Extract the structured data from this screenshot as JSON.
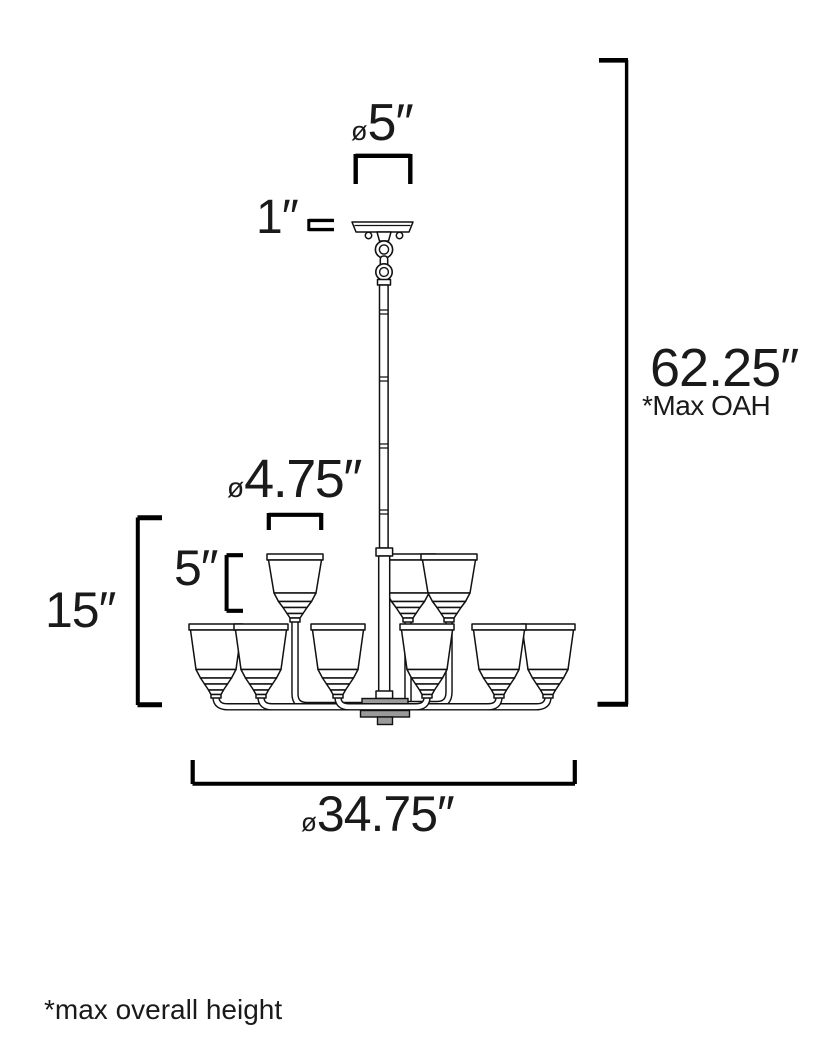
{
  "drawing": {
    "subject": "Two-tier chandelier dimensional line drawing",
    "upper_tier_shades": 3,
    "lower_tier_shades": 6,
    "colors": {
      "line": "#111111",
      "bracket": "#000000",
      "hub_fill": "#9a9a9a",
      "text": "#1a1a1a",
      "background": "#ffffff"
    }
  },
  "annotations": {
    "canopy_diameter": {
      "prefix": "ø",
      "value": "5″"
    },
    "canopy_height": {
      "value": "1″"
    },
    "max_overall_height": {
      "value": "62.25″",
      "note": "*Max OAH"
    },
    "upper_shade_diameter": {
      "prefix": "ø",
      "value": "4.75″"
    },
    "upper_shade_height": {
      "value": "5″"
    },
    "body_height": {
      "value": "15″"
    },
    "fixture_diameter": {
      "prefix": "ø",
      "value": "34.75″"
    },
    "footnote": "*max overall height"
  }
}
